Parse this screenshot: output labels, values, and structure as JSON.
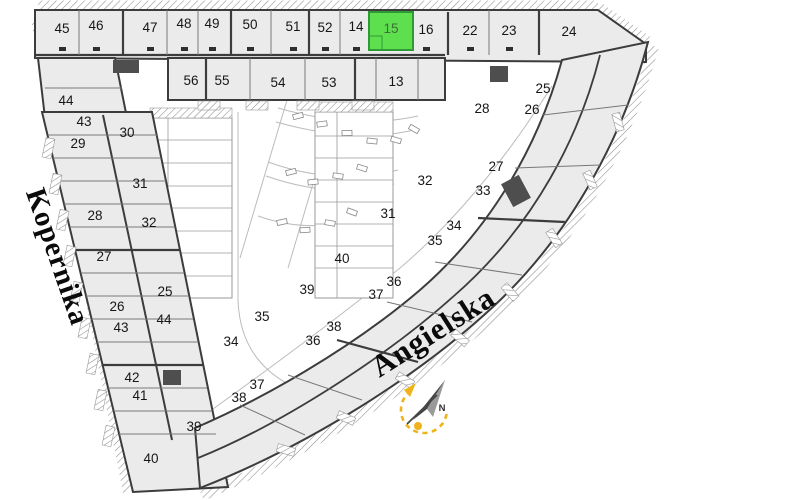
{
  "plan": {
    "background": "#ffffff",
    "highlight": {
      "unit": "15",
      "fill": "#5ddf4e",
      "border": "#2e9a33",
      "label_color": "#3f6e3c"
    },
    "accent_yellow": "#eeb31b",
    "streets": [
      {
        "name": "Kopernika"
      },
      {
        "name": "Angielska"
      }
    ],
    "compass": {
      "label": "N"
    },
    "units": [
      {
        "n": "45",
        "x": 62,
        "y": 28
      },
      {
        "n": "46",
        "x": 96,
        "y": 25
      },
      {
        "n": "47",
        "x": 150,
        "y": 27
      },
      {
        "n": "48",
        "x": 184,
        "y": 23
      },
      {
        "n": "49",
        "x": 212,
        "y": 23
      },
      {
        "n": "50",
        "x": 250,
        "y": 24
      },
      {
        "n": "51",
        "x": 293,
        "y": 26
      },
      {
        "n": "52",
        "x": 325,
        "y": 27
      },
      {
        "n": "14",
        "x": 356,
        "y": 26
      },
      {
        "n": "15",
        "x": 391,
        "y": 28,
        "highlight": true
      },
      {
        "n": "16",
        "x": 426,
        "y": 29
      },
      {
        "n": "22",
        "x": 470,
        "y": 30
      },
      {
        "n": "23",
        "x": 509,
        "y": 30
      },
      {
        "n": "24",
        "x": 569,
        "y": 31
      },
      {
        "n": "56",
        "x": 191,
        "y": 80
      },
      {
        "n": "55",
        "x": 222,
        "y": 80
      },
      {
        "n": "54",
        "x": 278,
        "y": 82
      },
      {
        "n": "53",
        "x": 329,
        "y": 82
      },
      {
        "n": "13",
        "x": 396,
        "y": 81
      },
      {
        "n": "44",
        "x": 66,
        "y": 100
      },
      {
        "n": "43",
        "x": 84,
        "y": 121
      },
      {
        "n": "30",
        "x": 127,
        "y": 132
      },
      {
        "n": "29",
        "x": 78,
        "y": 143
      },
      {
        "n": "31",
        "x": 140,
        "y": 183
      },
      {
        "n": "28",
        "x": 95,
        "y": 215
      },
      {
        "n": "32",
        "x": 149,
        "y": 222
      },
      {
        "n": "27",
        "x": 104,
        "y": 256
      },
      {
        "n": "25",
        "x": 165,
        "y": 291
      },
      {
        "n": "26",
        "x": 117,
        "y": 306
      },
      {
        "n": "44",
        "x": 164,
        "y": 319
      },
      {
        "n": "43",
        "x": 121,
        "y": 327
      },
      {
        "n": "35",
        "x": 262,
        "y": 316
      },
      {
        "n": "34",
        "x": 231,
        "y": 341
      },
      {
        "n": "36",
        "x": 313,
        "y": 340
      },
      {
        "n": "42",
        "x": 132,
        "y": 377
      },
      {
        "n": "37",
        "x": 257,
        "y": 384
      },
      {
        "n": "41",
        "x": 140,
        "y": 395
      },
      {
        "n": "38",
        "x": 239,
        "y": 397
      },
      {
        "n": "39",
        "x": 194,
        "y": 426
      },
      {
        "n": "40",
        "x": 151,
        "y": 458
      },
      {
        "n": "25",
        "x": 543,
        "y": 88
      },
      {
        "n": "28",
        "x": 482,
        "y": 108
      },
      {
        "n": "26",
        "x": 532,
        "y": 109
      },
      {
        "n": "27",
        "x": 496,
        "y": 166
      },
      {
        "n": "32",
        "x": 425,
        "y": 180
      },
      {
        "n": "33",
        "x": 483,
        "y": 190
      },
      {
        "n": "31",
        "x": 388,
        "y": 213
      },
      {
        "n": "34",
        "x": 454,
        "y": 225
      },
      {
        "n": "35",
        "x": 435,
        "y": 240
      },
      {
        "n": "40",
        "x": 342,
        "y": 258
      },
      {
        "n": "36",
        "x": 394,
        "y": 281
      },
      {
        "n": "39",
        "x": 307,
        "y": 289
      },
      {
        "n": "37",
        "x": 376,
        "y": 294
      },
      {
        "n": "38",
        "x": 334,
        "y": 326
      }
    ]
  }
}
